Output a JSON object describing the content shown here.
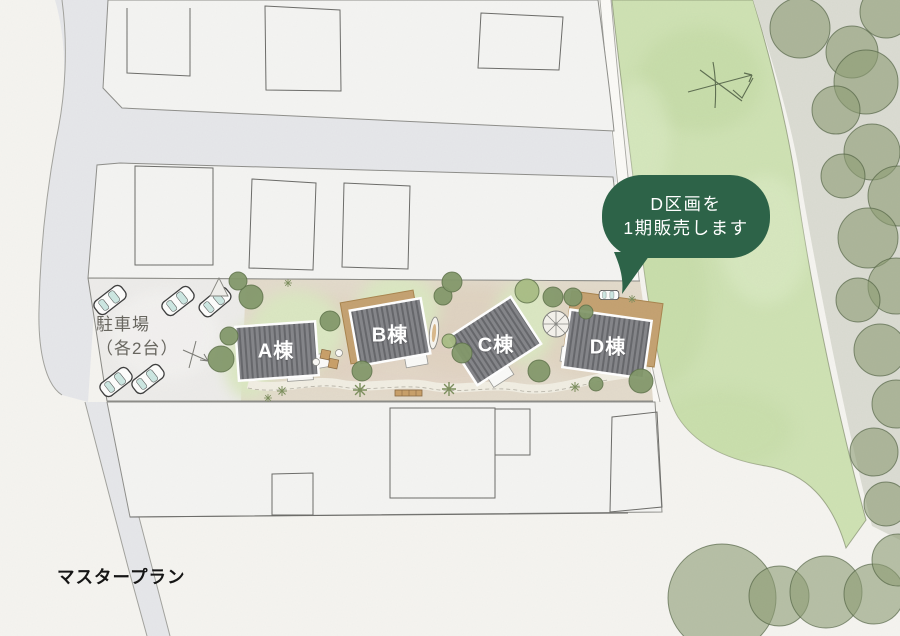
{
  "title": "マスタープラン",
  "buildings": [
    {
      "label": "A棟"
    },
    {
      "label": "B棟"
    },
    {
      "label": "C棟"
    },
    {
      "label": "D棟"
    }
  ],
  "parking": {
    "line1": "駐車場",
    "line2": "（各2台）"
  },
  "callout": {
    "line1": "D区画を",
    "line2": "1期販売します"
  },
  "colors": {
    "callout_green": "#2d6348",
    "field_green": "#cfe2b4",
    "tree_olive": "#84996b",
    "roof_gray": "#85868a",
    "deck_tan": "#c5a272",
    "road_gray": "#e6e7ea",
    "background": "#f5f4f0"
  }
}
